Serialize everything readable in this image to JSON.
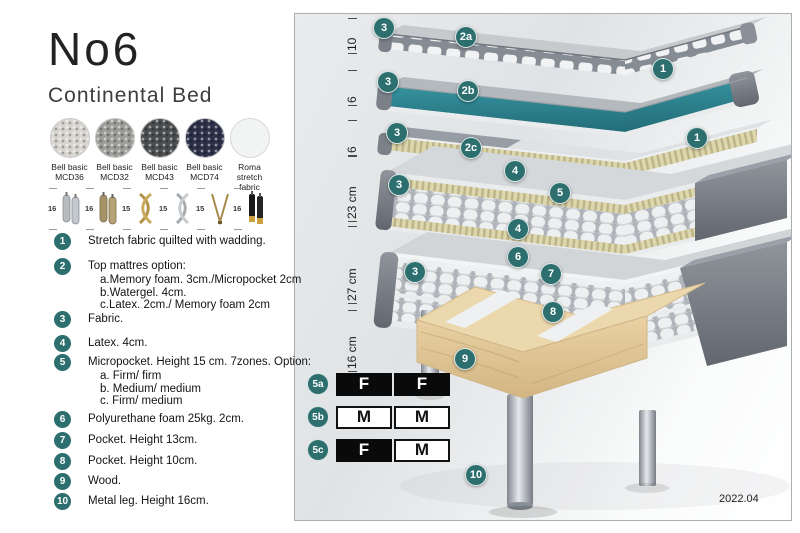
{
  "header": {
    "title": "No6",
    "subtitle": "Continental Bed"
  },
  "swatches": [
    {
      "line1": "Bell basic",
      "line2": "MCD36"
    },
    {
      "line1": "Bell basic",
      "line2": "MCD32"
    },
    {
      "line1": "Bell basic",
      "line2": "MCD43"
    },
    {
      "line1": "Bell basic",
      "line2": "MCD74"
    },
    {
      "line1": "Roma",
      "line2": "stretch fabric"
    }
  ],
  "legs": [
    {
      "height": "16",
      "type": "cylinder-silver-pair"
    },
    {
      "height": "16",
      "type": "cylinder-brass-pair"
    },
    {
      "height": "15",
      "type": "twisted-gold"
    },
    {
      "height": "15",
      "type": "twisted-silver"
    },
    {
      "height": "15",
      "type": "hairpin-gold"
    },
    {
      "height": "16",
      "type": "tapered-black-gold"
    }
  ],
  "legend": [
    {
      "num": "1",
      "text": "Stretch fabric quilted with wadding."
    },
    {
      "num": "2",
      "text": "Top mattres option:",
      "sub": [
        "a.Memory foam. 3cm./Micropocket 2cm",
        "b.Watergel. 4cm.",
        "c.Latex. 2cm./ Memory foam 2cm"
      ]
    },
    {
      "num": "3",
      "text": "Fabric."
    },
    {
      "num": "4",
      "text": "Latex. 4cm."
    },
    {
      "num": "5",
      "text": "Micropocket. Height 15 cm. 7zones. Option:",
      "sub": [
        "a. Firm/ firm",
        "b. Medium/ medium",
        "c. Firm/ medium"
      ]
    },
    {
      "num": "6",
      "text": "Polyurethane foam 25kg. 2cm."
    },
    {
      "num": "7",
      "text": "Pocket. Height 13cm."
    },
    {
      "num": "8",
      "text": "Pocket. Height 10cm."
    },
    {
      "num": "9",
      "text": "Wood."
    },
    {
      "num": "10",
      "text": "Metal leg. Height 16cm."
    }
  ],
  "diagram": {
    "dimensions": [
      "10",
      "6",
      "6",
      "23 cm",
      "27 cm",
      "16 cm"
    ],
    "badges": [
      "3",
      "2a",
      "1",
      "3",
      "2b",
      "3",
      "2c",
      "1",
      "3",
      "4",
      "5",
      "4",
      "3",
      "6",
      "7",
      "8",
      "9",
      "10"
    ],
    "firmness": {
      "rows": [
        {
          "label": "5a",
          "cells": [
            {
              "text": "F",
              "style": "dark"
            },
            {
              "text": "F",
              "style": "dark"
            }
          ]
        },
        {
          "label": "5b",
          "cells": [
            {
              "text": "M",
              "style": "light"
            },
            {
              "text": "M",
              "style": "light"
            }
          ]
        },
        {
          "label": "5c",
          "cells": [
            {
              "text": "F",
              "style": "dark"
            },
            {
              "text": "M",
              "style": "light"
            }
          ]
        }
      ]
    },
    "version": "2022.04"
  },
  "colors": {
    "badge_teal": "#2d6f6f",
    "watergel_teal": "#2e7f8a",
    "latex_cream": "#d9d3aa",
    "cover_grey": "#7a7f87",
    "wood_tan": "#e4cda0",
    "swatch_mcd36": "#d8d5d0",
    "swatch_mcd32": "#9d9c99",
    "swatch_mcd43": "#4b4d4f",
    "swatch_mcd74": "#2c3149",
    "swatch_roma": "#f2f3f3"
  }
}
